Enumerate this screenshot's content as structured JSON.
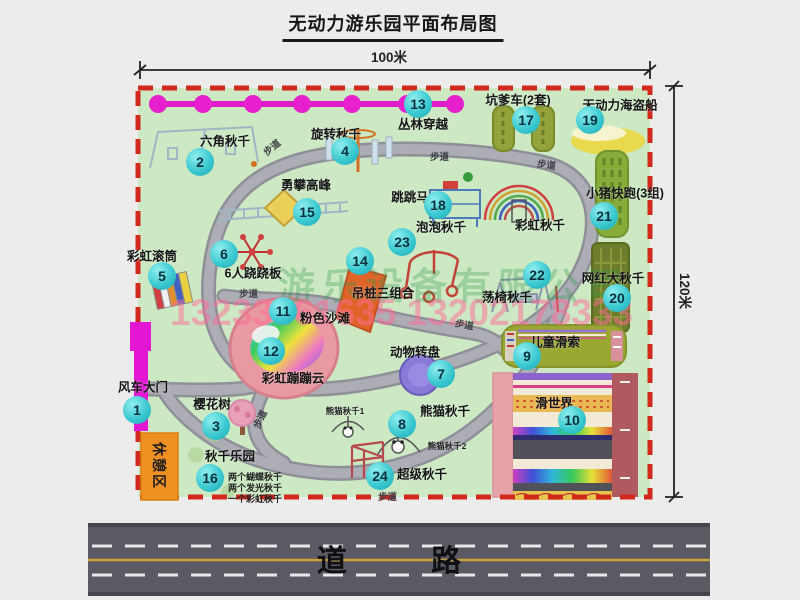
{
  "title": "无动力游乐园平面布局图",
  "dims": {
    "width": "100米",
    "height": "120米"
  },
  "road": {
    "label": "道 路"
  },
  "park": {
    "rest_area": "休憩区",
    "path_label": "步道"
  },
  "watermark": {
    "company": "游乐设备有限公司",
    "phone": "13233861635 13202178333"
  },
  "colors": {
    "park_green": "#cde9c4",
    "border_red": "#d2291e",
    "walkway_gray": "#a8a8b0",
    "bubble_teal": "#2fc4cc",
    "gate_magenta": "#e316d4",
    "chain_magenta": "#e01cc8",
    "road_gray": "#5a5a63",
    "rest_orange": "#ee9122"
  },
  "attractions": {
    "a1": {
      "num": "1",
      "label": "风车大门"
    },
    "a2": {
      "num": "2",
      "label": "六角秋千"
    },
    "a3": {
      "num": "3",
      "label": "樱花树"
    },
    "a4": {
      "num": "4",
      "label": "旋转秋千"
    },
    "a5": {
      "num": "5",
      "label": "彩虹滚筒"
    },
    "a6": {
      "num": "6",
      "label": "6人跷跷板"
    },
    "a7": {
      "num": "7",
      "label": "动物转盘"
    },
    "a8": {
      "num": "8",
      "label": "熊猫秋千",
      "sub1": "熊猫秋千1",
      "sub2": "熊猫秋千2"
    },
    "a9": {
      "num": "9",
      "label": "儿童滑索"
    },
    "a10": {
      "num": "10",
      "label": "滑世界"
    },
    "a11": {
      "num": "11",
      "label": "粉色沙滩"
    },
    "a12": {
      "num": "12",
      "label": "彩虹蹦蹦云"
    },
    "a13": {
      "num": "13",
      "label": "丛林穿越"
    },
    "a14": {
      "num": "14",
      "label": "吊桩三组合"
    },
    "a15": {
      "num": "15",
      "label": "勇攀高峰"
    },
    "a16": {
      "num": "16",
      "label": "秋千乐园",
      "notes": [
        "两个蝴蝶秋千",
        "两个发光秋千",
        "一个彩虹秋千"
      ]
    },
    "a17": {
      "num": "17",
      "label": "坑爹车(2套)"
    },
    "a18": {
      "num": "18",
      "label": "跳跳马"
    },
    "a19": {
      "num": "19",
      "label": "无动力海盗船"
    },
    "a20": {
      "num": "20",
      "label": "网红大秋千"
    },
    "a21": {
      "num": "21",
      "label": "小猪快跑(3组)"
    },
    "a22": {
      "num": "22",
      "label": "荡椅秋千"
    },
    "a23": {
      "num": "23",
      "label": "泡泡秋千"
    },
    "a24": {
      "num": "24",
      "label": "超级秋千"
    },
    "rainbow": {
      "label": "彩虹秋千"
    }
  }
}
